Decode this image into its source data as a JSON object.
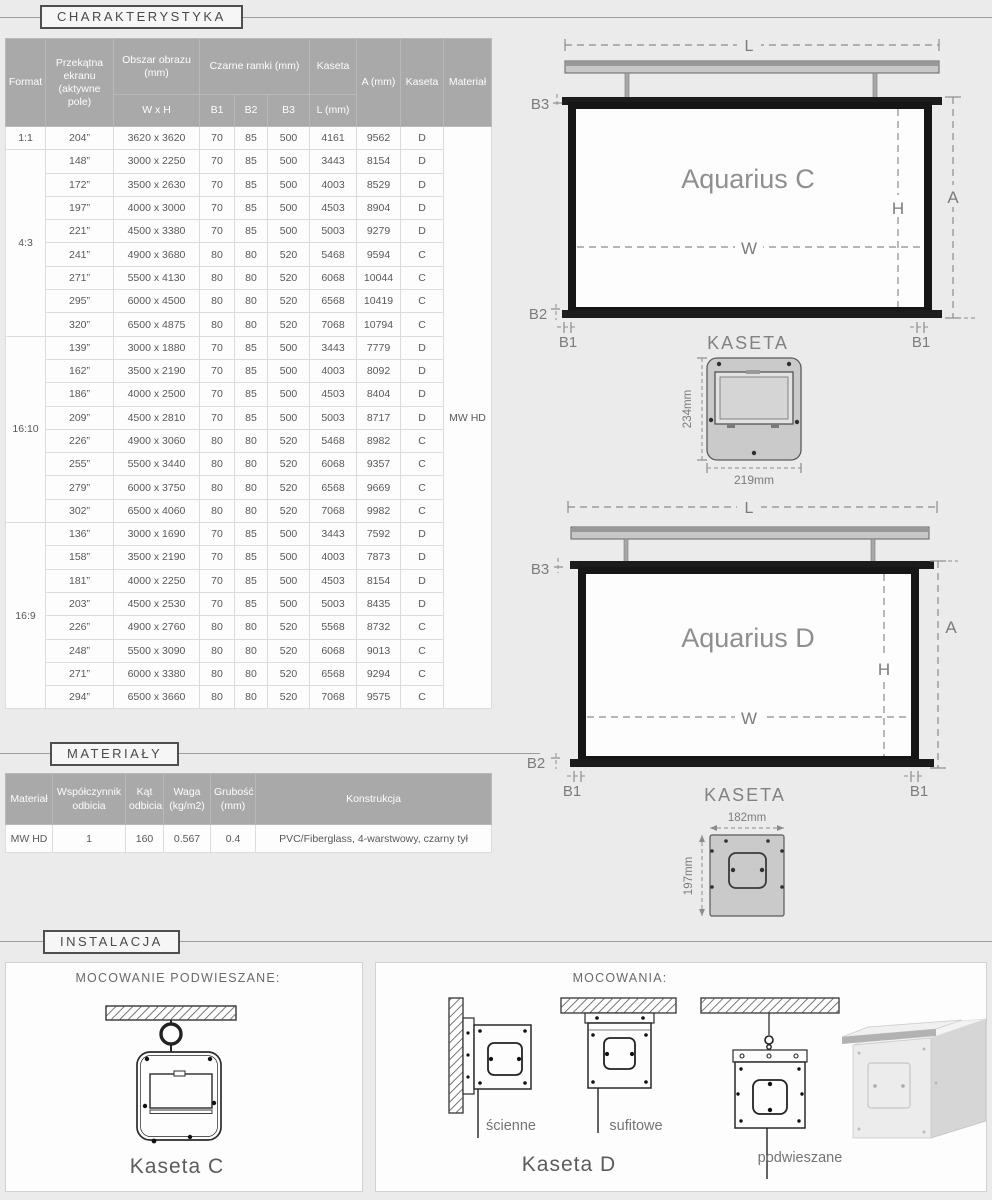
{
  "sections": {
    "charakterystyka": "CHARAKTERYSTYKA",
    "materialy": "MATERIAŁY",
    "instalacja": "INSTALACJA"
  },
  "char_table": {
    "header": {
      "format": "Format",
      "diagonal": "Przekątna ekranu (aktywne pole)",
      "image_area": "Obszar obrazu (mm)",
      "image_area_sub": "W x H",
      "black_frames": "Czarne ramki (mm)",
      "b1": "B1",
      "b2": "B2",
      "b3": "B3",
      "kaseta_group": "Kaseta",
      "kaseta_sub": "L (mm)",
      "a": "A (mm)",
      "kaseta": "Kaseta",
      "material": "Materiał"
    },
    "material_value": "MW HD",
    "groups": [
      {
        "format": "1:1",
        "rows": [
          [
            "204”",
            "3620 x 3620",
            "70",
            "85",
            "500",
            "4161",
            "9562",
            "D"
          ]
        ]
      },
      {
        "format": "4:3",
        "rows": [
          [
            "148”",
            "3000 x 2250",
            "70",
            "85",
            "500",
            "3443",
            "8154",
            "D"
          ],
          [
            "172”",
            "3500 x 2630",
            "70",
            "85",
            "500",
            "4003",
            "8529",
            "D"
          ],
          [
            "197”",
            "4000 x 3000",
            "70",
            "85",
            "500",
            "4503",
            "8904",
            "D"
          ],
          [
            "221”",
            "4500 x 3380",
            "70",
            "85",
            "500",
            "5003",
            "9279",
            "D"
          ],
          [
            "241”",
            "4900 x 3680",
            "80",
            "80",
            "520",
            "5468",
            "9594",
            "C"
          ],
          [
            "271”",
            "5500 x 4130",
            "80",
            "80",
            "520",
            "6068",
            "10044",
            "C"
          ],
          [
            "295”",
            "6000 x 4500",
            "80",
            "80",
            "520",
            "6568",
            "10419",
            "C"
          ],
          [
            "320”",
            "6500 x 4875",
            "80",
            "80",
            "520",
            "7068",
            "10794",
            "C"
          ]
        ]
      },
      {
        "format": "16:10",
        "rows": [
          [
            "139”",
            "3000 x 1880",
            "70",
            "85",
            "500",
            "3443",
            "7779",
            "D"
          ],
          [
            "162”",
            "3500 x 2190",
            "70",
            "85",
            "500",
            "4003",
            "8092",
            "D"
          ],
          [
            "186”",
            "4000 x 2500",
            "70",
            "85",
            "500",
            "4503",
            "8404",
            "D"
          ],
          [
            "209”",
            "4500 x 2810",
            "70",
            "85",
            "500",
            "5003",
            "8717",
            "D"
          ],
          [
            "226”",
            "4900 x 3060",
            "80",
            "80",
            "520",
            "5468",
            "8982",
            "C"
          ],
          [
            "255”",
            "5500 x 3440",
            "80",
            "80",
            "520",
            "6068",
            "9357",
            "C"
          ],
          [
            "279”",
            "6000 x 3750",
            "80",
            "80",
            "520",
            "6568",
            "9669",
            "C"
          ],
          [
            "302”",
            "6500 x 4060",
            "80",
            "80",
            "520",
            "7068",
            "9982",
            "C"
          ]
        ]
      },
      {
        "format": "16:9",
        "rows": [
          [
            "136”",
            "3000 x 1690",
            "70",
            "85",
            "500",
            "3443",
            "7592",
            "D"
          ],
          [
            "158”",
            "3500 x 2190",
            "70",
            "85",
            "500",
            "4003",
            "7873",
            "D"
          ],
          [
            "181”",
            "4000 x 2250",
            "70",
            "85",
            "500",
            "4503",
            "8154",
            "D"
          ],
          [
            "203”",
            "4500 x 2530",
            "70",
            "85",
            "500",
            "5003",
            "8435",
            "D"
          ],
          [
            "226”",
            "4900 x 2760",
            "80",
            "80",
            "520",
            "5568",
            "8732",
            "C"
          ],
          [
            "248”",
            "5500 x 3090",
            "80",
            "80",
            "520",
            "6068",
            "9013",
            "C"
          ],
          [
            "271”",
            "6000 x 3380",
            "80",
            "80",
            "520",
            "6568",
            "9294",
            "C"
          ],
          [
            "294”",
            "6500 x 3660",
            "80",
            "80",
            "520",
            "7068",
            "9575",
            "C"
          ]
        ]
      }
    ]
  },
  "materials_table": {
    "headers": [
      "Materiał",
      "Współczynnik odbicia",
      "Kąt odbicia",
      "Waga (kg/m2)",
      "Grubość (mm)",
      "Konstrukcja"
    ],
    "row": [
      "MW HD",
      "1",
      "160",
      "0.567",
      "0.4",
      "PVC/Fiberglass, 4-warstwowy, czarny tył"
    ]
  },
  "diagram_c": {
    "title": "Aquarius C",
    "kaseta": "KASETA",
    "dim_l": "L",
    "dim_a": "A",
    "dim_h": "H",
    "dim_w": "W",
    "dim_b1": "B1",
    "dim_b2": "B2",
    "dim_b3": "B3",
    "cs_height": "234mm",
    "cs_width": "219mm"
  },
  "diagram_d": {
    "title": "Aquarius D",
    "kaseta": "KASETA",
    "dim_l": "L",
    "dim_a": "A",
    "dim_h": "H",
    "dim_w": "W",
    "dim_b1": "B1",
    "dim_b2": "B2",
    "dim_b3": "B3",
    "cs_width": "182mm",
    "cs_height": "197mm"
  },
  "installation": {
    "left_panel": {
      "title": "MOCOWANIE PODWIESZANE:",
      "caption": "Kaseta C"
    },
    "right_panel": {
      "title": "MOCOWANIA:",
      "labels": [
        "ścienne",
        "sufitowe",
        "podwieszane"
      ],
      "caption": "Kaseta D"
    }
  },
  "colors": {
    "page_bg": "#ebebeb",
    "table_header_bg": "#a9a9a9",
    "panel_bg": "#fdfdfd",
    "accent_text": "#4a4a4a",
    "frame_black": "#161616"
  }
}
